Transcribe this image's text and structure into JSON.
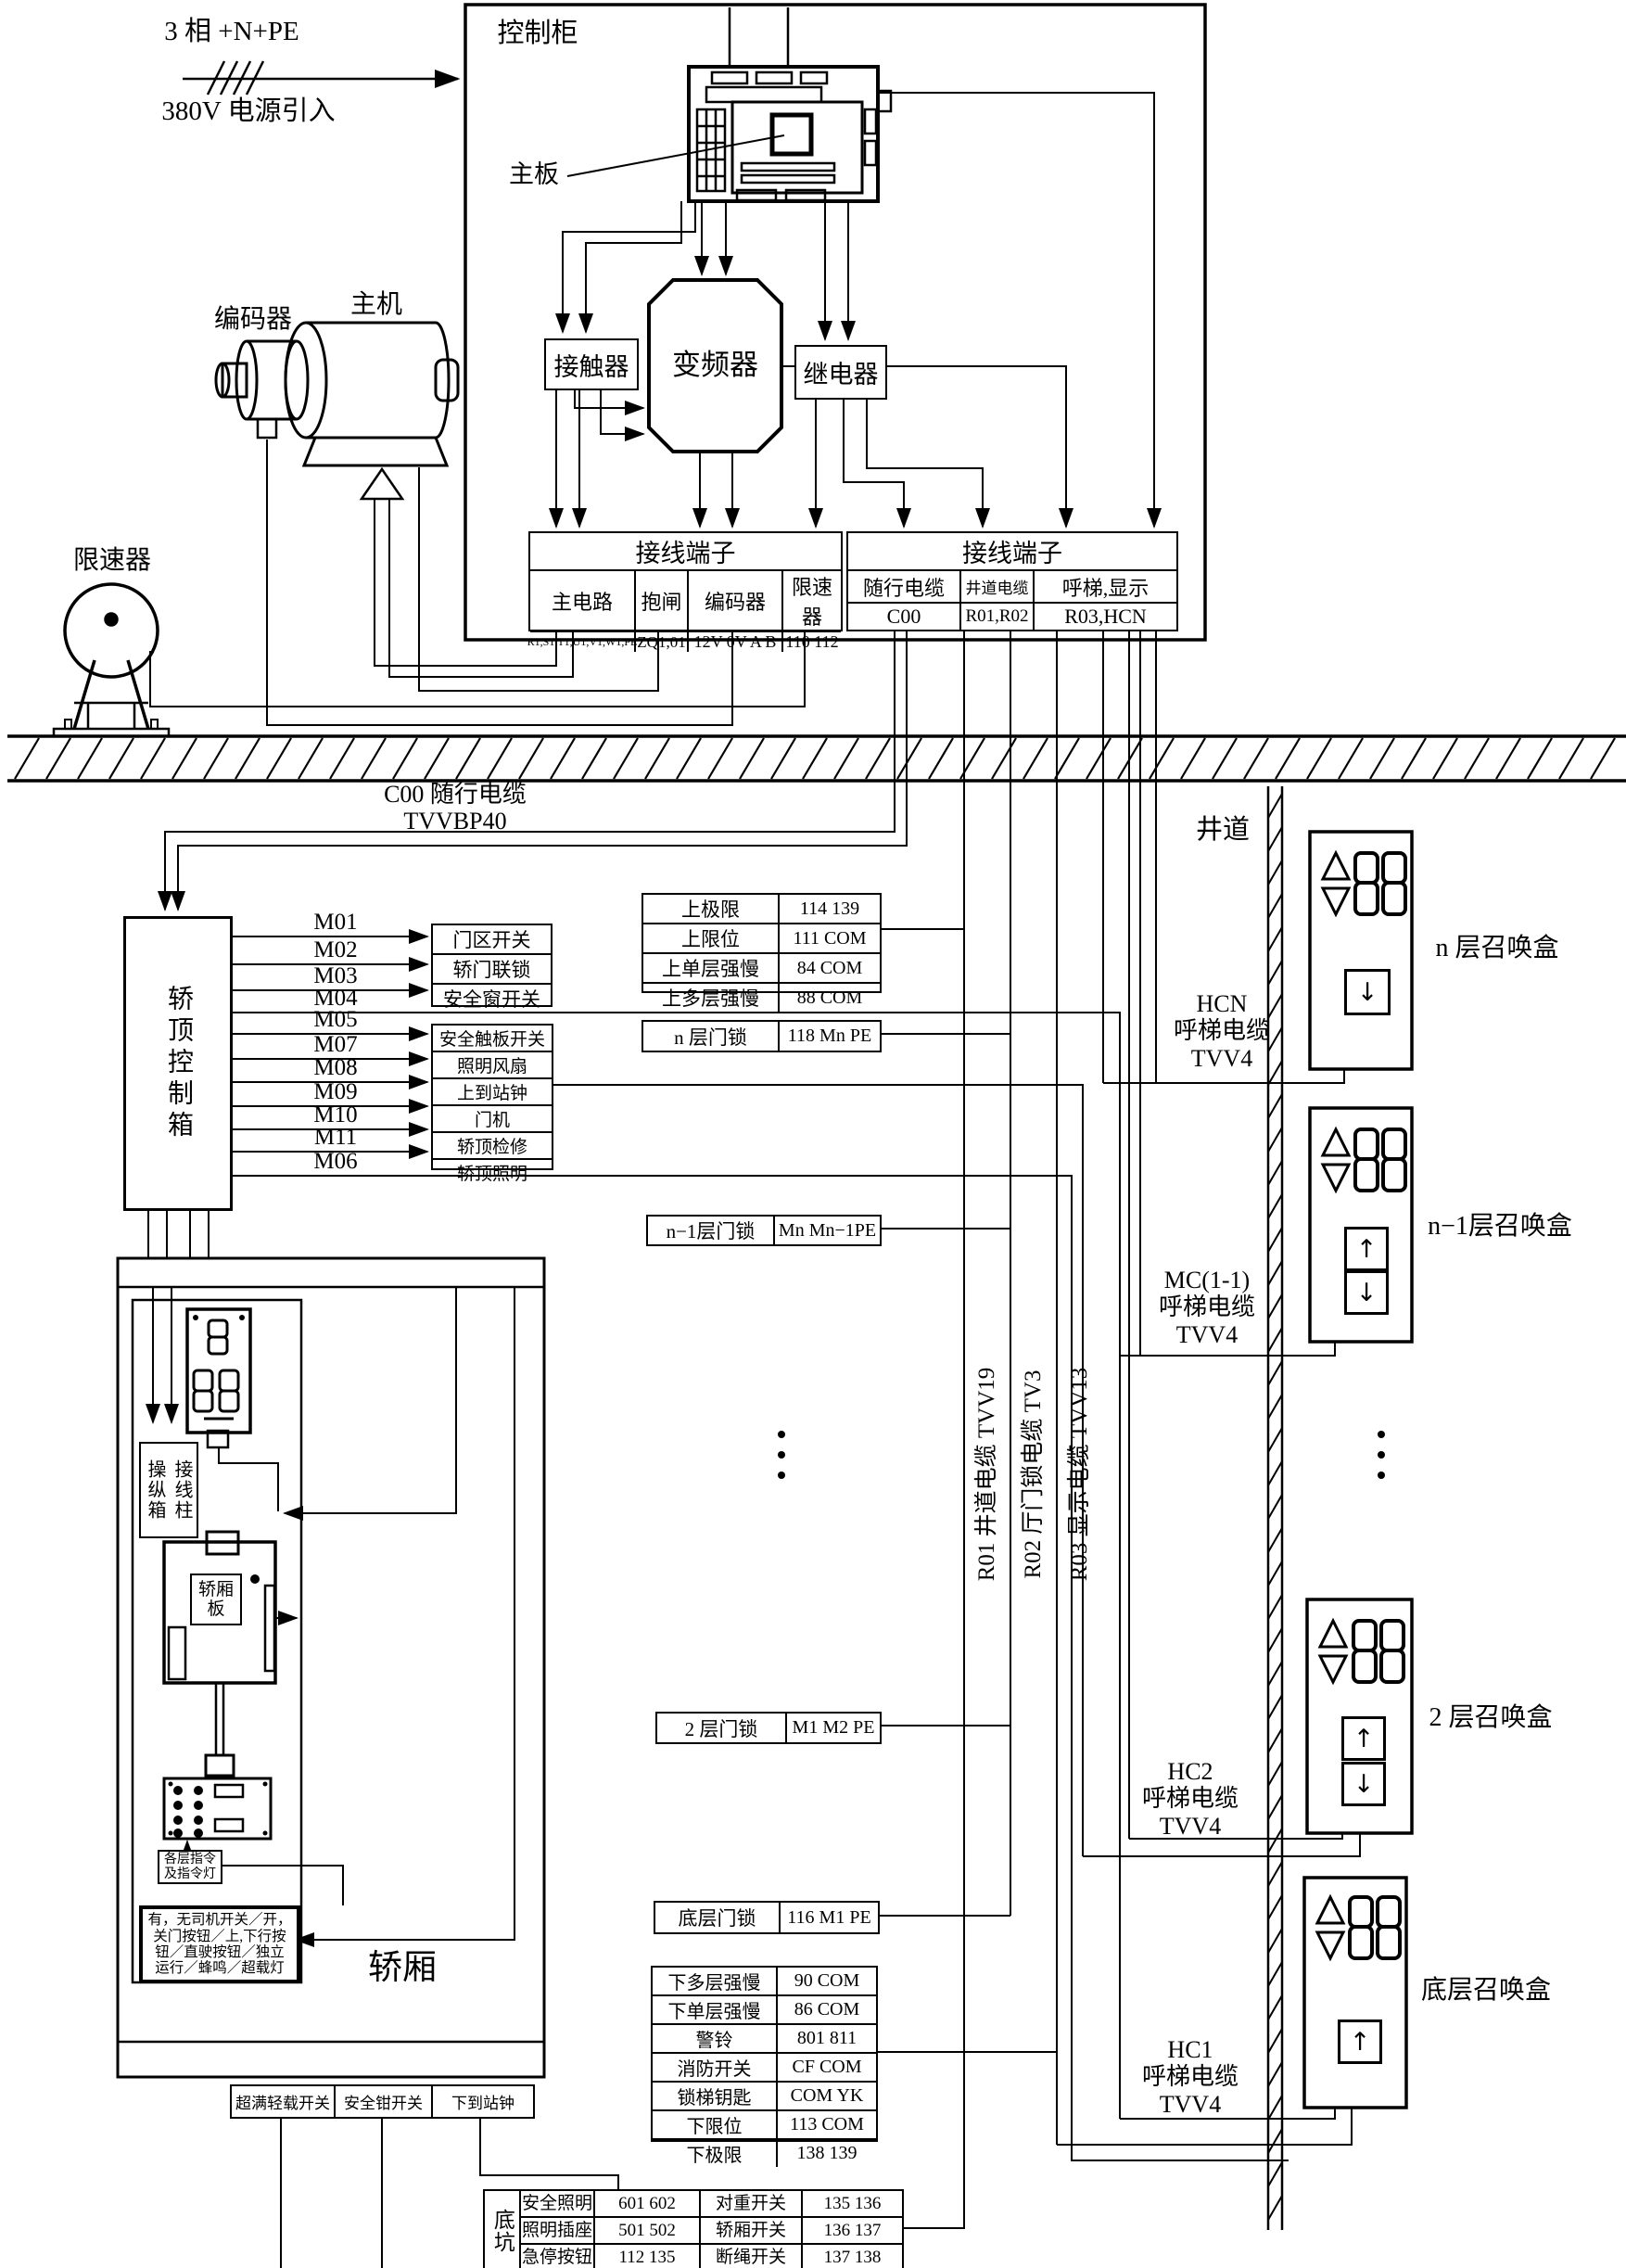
{
  "power": {
    "line1": "3 相 +N+PE",
    "line2": "380V 电源引入"
  },
  "cabinet": {
    "title": "控制柜",
    "mainboard": "主板",
    "contactor": "接触器",
    "inverter": "变频器",
    "relay": "继电器"
  },
  "terminal_left": {
    "title": "接线端子",
    "cols": [
      {
        "name": "主电路",
        "value": "R1,S1,T1,U1,V1,W1,PE"
      },
      {
        "name": "抱闸",
        "value": "ZQ1,01"
      },
      {
        "name": "编码器",
        "value": "12V 0V A B"
      },
      {
        "name": "限速器",
        "value": "110  112"
      }
    ]
  },
  "terminal_right": {
    "title": "接线端子",
    "cols": [
      {
        "name": "随行电缆",
        "value": "C00"
      },
      {
        "name": "井道电缆",
        "value": "R01,R02"
      },
      {
        "name": "呼梯,显示",
        "value": "R03,HCN"
      }
    ]
  },
  "machines": {
    "encoder": "编码器",
    "motor": "主机",
    "governor": "限速器"
  },
  "travel_cable_label": "C00  随行电缆 TVVBP40",
  "car_top_box": {
    "label": "轿顶控制箱"
  },
  "m_lines": [
    "M01",
    "M02",
    "M03",
    "M04",
    "M05",
    "M07",
    "M08",
    "M09",
    "M10",
    "M11",
    "M06"
  ],
  "group1": [
    "门区开关",
    "轿门联锁",
    "安全窗开关"
  ],
  "group2": [
    "安全触板开关",
    "照明风扇",
    "上到站钟",
    "门机",
    "轿顶检修",
    "轿顶照明"
  ],
  "upper_table": [
    {
      "l": "上极限",
      "v": "114  139"
    },
    {
      "l": "上限位",
      "v": "111  COM"
    },
    {
      "l": "上单层强慢",
      "v": "84  COM"
    },
    {
      "l": "上多层强慢",
      "v": "88  COM"
    }
  ],
  "door_locks": [
    {
      "l": "n 层门锁",
      "v": "118 Mn PE"
    },
    {
      "l": "n−1层门锁",
      "v": "Mn Mn−1PE"
    },
    {
      "l": "2 层门锁",
      "v": "M1 M2 PE"
    },
    {
      "l": "底层门锁",
      "v": "116 M1 PE"
    }
  ],
  "lower_table": [
    {
      "l": "下多层强慢",
      "v": "90  COM"
    },
    {
      "l": "下单层强慢",
      "v": "86  COM"
    },
    {
      "l": "警铃",
      "v": "801  811"
    },
    {
      "l": "消防开关",
      "v": "CF  COM"
    },
    {
      "l": "锁梯钥匙",
      "v": "COM YK"
    },
    {
      "l": "下限位",
      "v": "113  COM"
    },
    {
      "l": "下极限",
      "v": "138  139"
    }
  ],
  "riser_labels": [
    "R01 井道电缆  TVV19",
    "R02 厅门锁电缆  TV3",
    "R03 显示电缆 TVV13"
  ],
  "shaft_label": "井道",
  "call_groups": [
    {
      "cable": "HCN\n呼梯电缆\nTVV4",
      "label": "n 层召唤盒",
      "down_arrow": "↓"
    },
    {
      "cable": "MC(1-1)\n呼梯电缆\nTVV4",
      "label": "n−1层召唤盒",
      "up_arrow": "↑",
      "down_arrow": "↓"
    },
    {
      "cable": "HC2\n呼梯电缆\nTVV4",
      "label": "2 层召唤盒",
      "up_arrow": "↑",
      "down_arrow": "↓"
    },
    {
      "cable": "HC1\n呼梯电缆\nTVV4",
      "label": "底层召唤盒",
      "up_arrow": "↑"
    }
  ],
  "car": {
    "label": "轿厢",
    "panel_left": "操纵箱",
    "panel_right": "接线柱",
    "board": "轿厢\n板",
    "cmd": "各层指令\n及指令灯",
    "features": "有，无司机开关／开，\n关门按钮／上,下行按\n钮／直驶按钮／独立\n运行／蜂鸣／超载灯"
  },
  "car_bottom": [
    "超满轻载开关",
    "安全钳开关",
    "下到站钟"
  ],
  "pit": {
    "label": "底坑",
    "rows": [
      {
        "l1": "安全照明",
        "v1": "601    602",
        "l2": "对重开关",
        "v2": "135    136"
      },
      {
        "l1": "照明插座",
        "v1": "501    502",
        "l2": "轿厢开关",
        "v2": "136    137"
      },
      {
        "l1": "急停按钮",
        "v1": "112    135",
        "l2": "断绳开关",
        "v2": "137    138"
      }
    ]
  }
}
